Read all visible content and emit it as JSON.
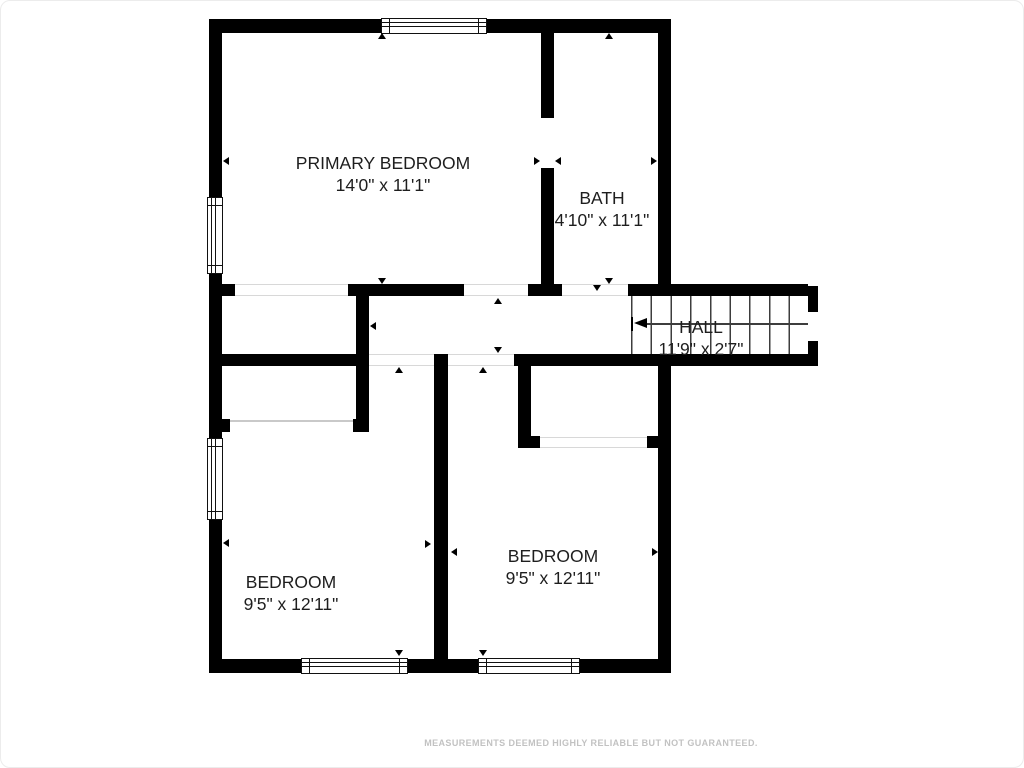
{
  "rooms": [
    {
      "id": "primary-bedroom",
      "label": "PRIMARY BEDROOM",
      "dimensions": "14'0\" x 11'1\""
    },
    {
      "id": "bath",
      "label": "BATH",
      "dimensions": "4'10\" x 11'1\""
    },
    {
      "id": "hall",
      "label": "HALL",
      "dimensions": "11'9\" x 2'7\""
    },
    {
      "id": "bedroom-left",
      "label": "BEDROOM",
      "dimensions": "9'5\" x 12'11\""
    },
    {
      "id": "bedroom-right",
      "label": "BEDROOM",
      "dimensions": "9'5\" x 12'11\""
    }
  ],
  "footer": {
    "disclaimer": "MEASUREMENTS DEEMED HIGHLY RELIABLE BUT NOT GUARANTEED."
  },
  "colors": {
    "wall": "#000000",
    "label_text": "#1e1e1e",
    "disclaimer_text": "#c2c2c2",
    "threshold_line": "#d8d8d8",
    "stair_lines": "#3d3d3d",
    "background": "#ffffff"
  }
}
